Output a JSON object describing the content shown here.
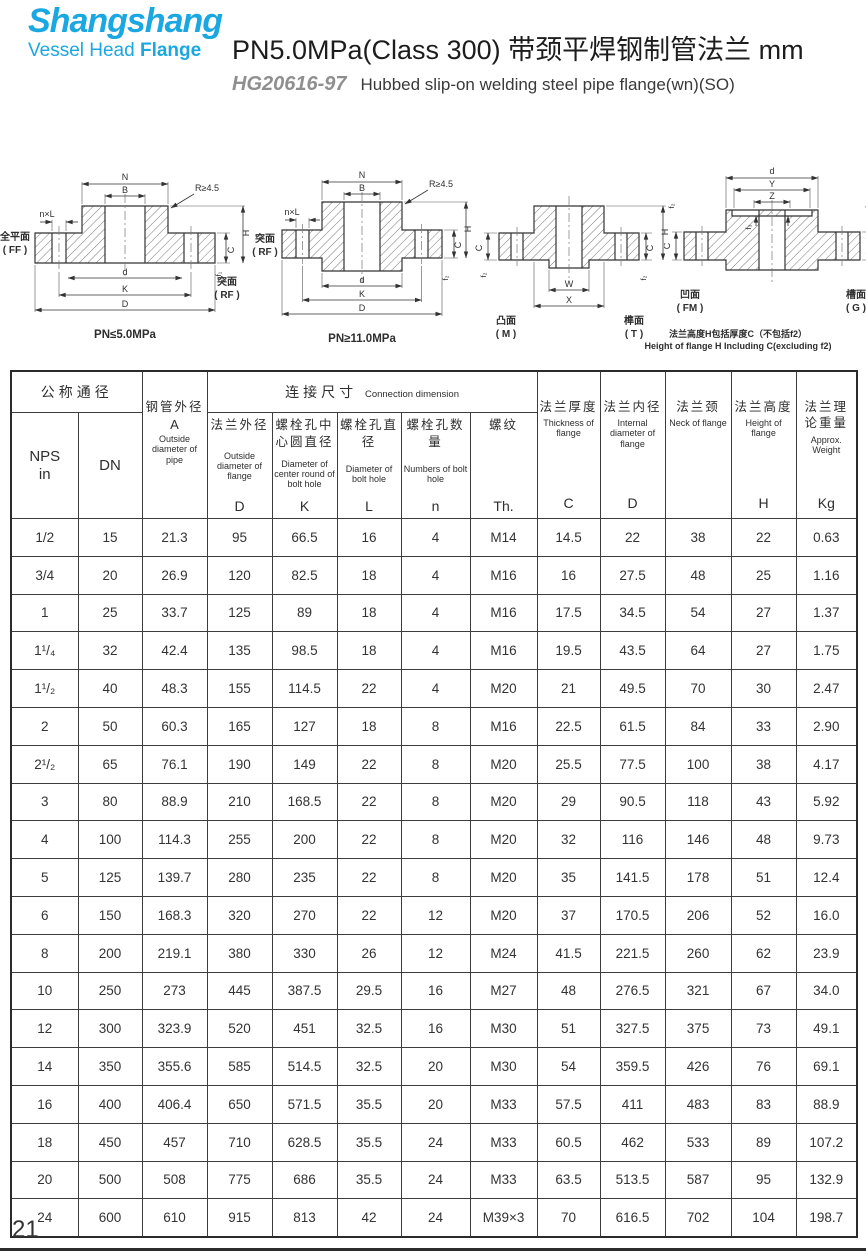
{
  "brand": {
    "name": "Shangshang",
    "tag_vessel": "Vessel Head ",
    "tag_flange": "Flange"
  },
  "title": {
    "main": "PN5.0MPa(Class 300) 带颈平焊钢制管法兰  mm",
    "standard": "HG20616-97",
    "subtitle": "Hubbed slip-on welding steel pipe flange(wn)(SO)"
  },
  "drawings": {
    "d1": {
      "dims": {
        "N": "N",
        "B": "B",
        "nxL": "n×L",
        "R": "R≥4.5",
        "d": "d",
        "K": "K",
        "D": "D",
        "C": "C",
        "H": "H",
        "f": "f₁"
      },
      "face_left_cn": "全平面",
      "face_left_en": "( FF )",
      "face_right_cn": "突面",
      "face_right_en": "( RF )",
      "caption": "PN≤5.0MPa"
    },
    "d2": {
      "dims": {
        "N": "N",
        "B": "B",
        "nxL": "n×L",
        "R": "R≥4.5",
        "d": "d",
        "K": "K",
        "D": "D",
        "C": "C",
        "H": "H",
        "f": "f₂"
      },
      "face_left_cn": "突面",
      "face_left_en": "( RF )",
      "caption": "PN≥11.0MPa"
    },
    "d3": {
      "dims": {
        "W": "W",
        "X": "X",
        "C_left": "C",
        "C_right": "C",
        "H": "H",
        "f_left": "f₂",
        "f_right": "f₂"
      },
      "face_left_cn": "凸面",
      "face_left_en": "( M )",
      "face_right_cn": "榫面",
      "face_right_en": "( T )"
    },
    "d4": {
      "dims": {
        "d": "d",
        "Y": "Y",
        "Z": "Z",
        "f2_left": "f₂",
        "f2_right": "f₂",
        "f3": "f₃",
        "C_left": "C",
        "C_right": "C"
      },
      "face_left_cn": "凹面",
      "face_left_en": "( FM )",
      "face_right_cn": "槽面",
      "face_right_en": "( G )",
      "note_cn": "法兰高度H包括厚度C（不包括f2）",
      "note_en": "Height of flange H Including C(excluding f2)"
    }
  },
  "table": {
    "group_nominal": "公称通径",
    "group_connection_cn": "连接尺寸",
    "group_connection_en": "Connection dimension",
    "columns": {
      "nps": {
        "letter": "NPS\nin"
      },
      "dn": {
        "letter": "DN"
      },
      "pipe_od": {
        "cn": "钢管外径",
        "mid": "A",
        "en": "Outside diameter of pipe"
      },
      "flange_od": {
        "cn": "法兰外径",
        "en": "Outside diameter of flange",
        "letter": "D"
      },
      "bolt_circle": {
        "cn": "螺栓孔中心圆直径",
        "en": "Diameter of center round of bolt hole",
        "letter": "K"
      },
      "bolt_dia": {
        "cn": "螺栓孔直径",
        "en": "Diameter of bolt hole",
        "letter": "L"
      },
      "bolt_num": {
        "cn": "螺栓孔数量",
        "en": "Numbers of bolt hole",
        "letter": "n"
      },
      "thread": {
        "cn": "螺纹",
        "en": "",
        "letter": "Th."
      },
      "thickness": {
        "cn": "法兰厚度",
        "en": "Thickness of flange",
        "letter": "C"
      },
      "inner_dia": {
        "cn": "法兰内径",
        "en": "Internal diameter of flange",
        "letter": "D"
      },
      "neck": {
        "cn": "法兰颈",
        "en": "Neck of flange",
        "letter": ""
      },
      "height": {
        "cn": "法兰高度",
        "en": "Height of flange",
        "letter": "H"
      },
      "weight": {
        "cn": "法兰理论重量",
        "en": "Approx. Weight",
        "letter": "Kg"
      }
    },
    "rows": [
      [
        "1/2",
        "15",
        "21.3",
        "95",
        "66.5",
        "16",
        "4",
        "M14",
        "14.5",
        "22",
        "38",
        "22",
        "0.63"
      ],
      [
        "3/4",
        "20",
        "26.9",
        "120",
        "82.5",
        "18",
        "4",
        "M16",
        "16",
        "27.5",
        "48",
        "25",
        "1.16"
      ],
      [
        "1",
        "25",
        "33.7",
        "125",
        "89",
        "18",
        "4",
        "M16",
        "17.5",
        "34.5",
        "54",
        "27",
        "1.37"
      ],
      [
        "1¹/₄",
        "32",
        "42.4",
        "135",
        "98.5",
        "18",
        "4",
        "M16",
        "19.5",
        "43.5",
        "64",
        "27",
        "1.75"
      ],
      [
        "1¹/₂",
        "40",
        "48.3",
        "155",
        "114.5",
        "22",
        "4",
        "M20",
        "21",
        "49.5",
        "70",
        "30",
        "2.47"
      ],
      [
        "2",
        "50",
        "60.3",
        "165",
        "127",
        "18",
        "8",
        "M16",
        "22.5",
        "61.5",
        "84",
        "33",
        "2.90"
      ],
      [
        "2¹/₂",
        "65",
        "76.1",
        "190",
        "149",
        "22",
        "8",
        "M20",
        "25.5",
        "77.5",
        "100",
        "38",
        "4.17"
      ],
      [
        "3",
        "80",
        "88.9",
        "210",
        "168.5",
        "22",
        "8",
        "M20",
        "29",
        "90.5",
        "118",
        "43",
        "5.92"
      ],
      [
        "4",
        "100",
        "114.3",
        "255",
        "200",
        "22",
        "8",
        "M20",
        "32",
        "116",
        "146",
        "48",
        "9.73"
      ],
      [
        "5",
        "125",
        "139.7",
        "280",
        "235",
        "22",
        "8",
        "M20",
        "35",
        "141.5",
        "178",
        "51",
        "12.4"
      ],
      [
        "6",
        "150",
        "168.3",
        "320",
        "270",
        "22",
        "12",
        "M20",
        "37",
        "170.5",
        "206",
        "52",
        "16.0"
      ],
      [
        "8",
        "200",
        "219.1",
        "380",
        "330",
        "26",
        "12",
        "M24",
        "41.5",
        "221.5",
        "260",
        "62",
        "23.9"
      ],
      [
        "10",
        "250",
        "273",
        "445",
        "387.5",
        "29.5",
        "16",
        "M27",
        "48",
        "276.5",
        "321",
        "67",
        "34.0"
      ],
      [
        "12",
        "300",
        "323.9",
        "520",
        "451",
        "32.5",
        "16",
        "M30",
        "51",
        "327.5",
        "375",
        "73",
        "49.1"
      ],
      [
        "14",
        "350",
        "355.6",
        "585",
        "514.5",
        "32.5",
        "20",
        "M30",
        "54",
        "359.5",
        "426",
        "76",
        "69.1"
      ],
      [
        "16",
        "400",
        "406.4",
        "650",
        "571.5",
        "35.5",
        "20",
        "M33",
        "57.5",
        "411",
        "483",
        "83",
        "88.9"
      ],
      [
        "18",
        "450",
        "457",
        "710",
        "628.5",
        "35.5",
        "24",
        "M33",
        "60.5",
        "462",
        "533",
        "89",
        "107.2"
      ],
      [
        "20",
        "500",
        "508",
        "775",
        "686",
        "35.5",
        "24",
        "M33",
        "63.5",
        "513.5",
        "587",
        "95",
        "132.9"
      ],
      [
        "24",
        "600",
        "610",
        "915",
        "813",
        "42",
        "24",
        "M39×3",
        "70",
        "616.5",
        "702",
        "104",
        "198.7"
      ]
    ]
  },
  "page_number": "21"
}
